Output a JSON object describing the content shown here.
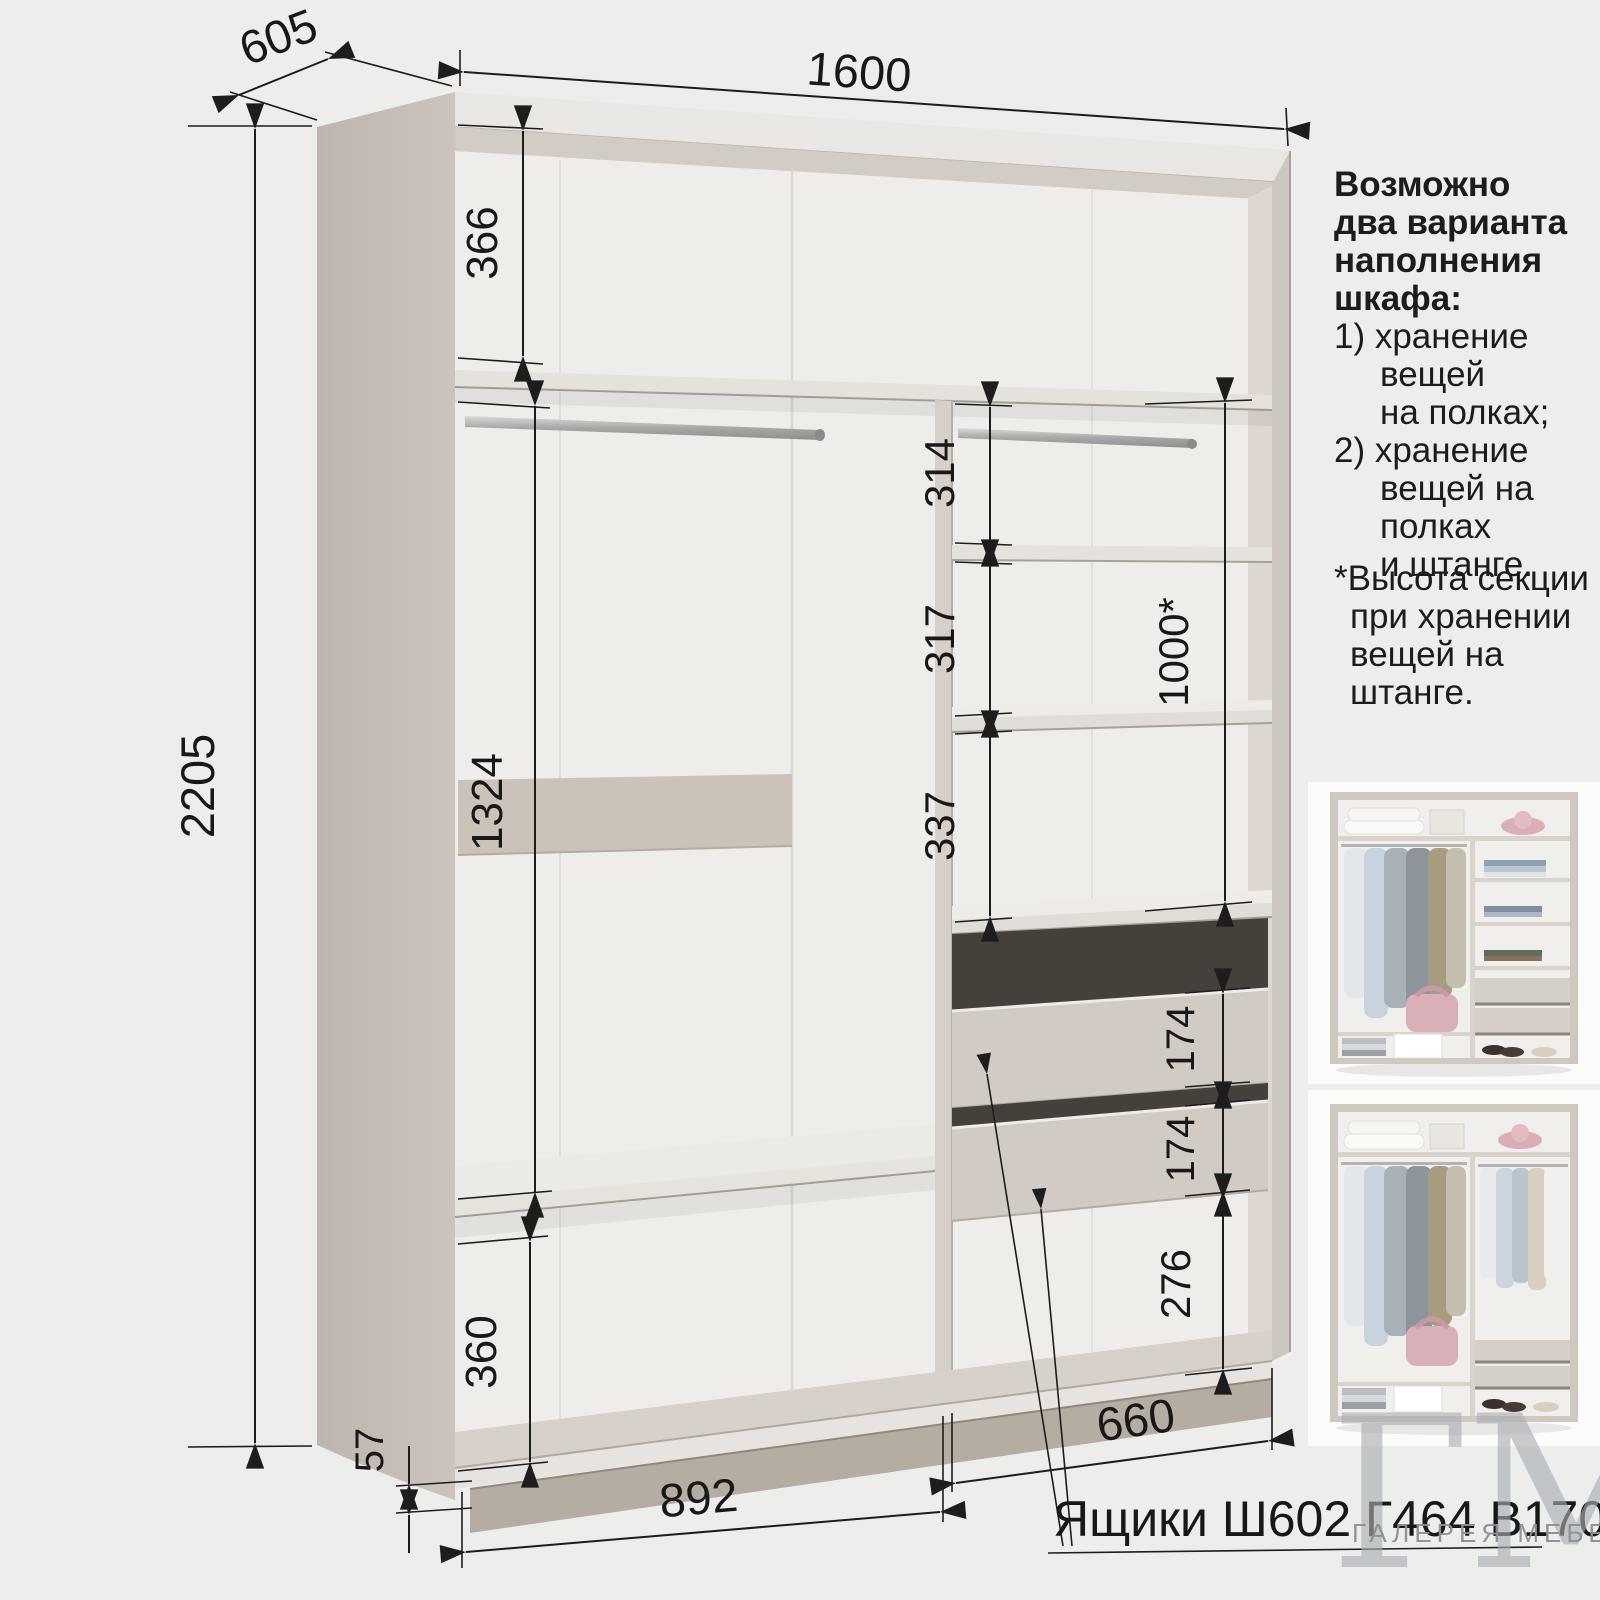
{
  "dimensions": {
    "width_total": "1600",
    "depth": "605",
    "height_total": "2205",
    "left_top_section": "366",
    "left_hanging_section": "1324",
    "left_bottom_section": "360",
    "plinth_height": "57",
    "left_section_width": "892",
    "right_section_width": "660",
    "right_shelf_1": "314",
    "right_shelf_2": "317",
    "right_shelf_3": "337",
    "right_rod_section": "1000*",
    "drawer_upper": "174",
    "drawer_lower": "174",
    "right_bottom_space": "276"
  },
  "labels": {
    "drawers_note": "Ящики Ш602 Г464 В170"
  },
  "notes": {
    "heading_lines": [
      "Возможно",
      "два варианта",
      "наполнения",
      "шкафа:"
    ],
    "item1_lines": [
      "1) хранение",
      "вещей",
      "на полках;"
    ],
    "item2_lines": [
      "2) хранение",
      "вещей на",
      "полках",
      "и штанге."
    ],
    "footnote_lines": [
      "*Высота секции",
      "при хранении",
      "вещей на",
      "штанге."
    ]
  },
  "logo": {
    "monogram": "ГМ",
    "caption": "ГАЛЕРЕЯ МЕБЕЛИ"
  },
  "colors": {
    "background": "#ededec",
    "carcass_beige": "#c7bfb7",
    "interior_white": "#efede9",
    "drawer_front": "#d2cbc3",
    "dimension_lines": "#1d1d1d",
    "logo_gray": "#a9adb1"
  }
}
